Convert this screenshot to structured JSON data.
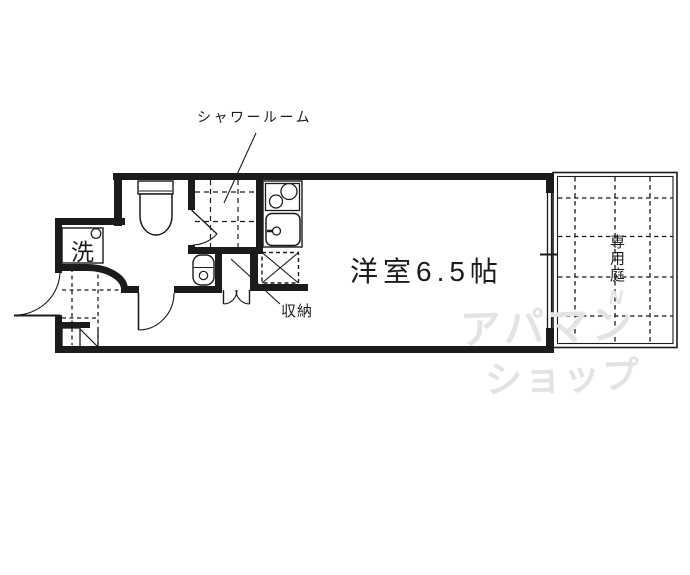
{
  "floorplan": {
    "labels": {
      "shower_room": "シャワールーム",
      "main_room": "洋室6.5帖",
      "storage": "収納",
      "washer": "洗",
      "private_garden": "専用庭"
    },
    "watermark": {
      "line1": "アパマン",
      "line2": "ショップ",
      "mark": "N"
    },
    "colors": {
      "line": "#1b1b1b",
      "watermark": "#e3e3e3",
      "background": "#ffffff"
    }
  }
}
